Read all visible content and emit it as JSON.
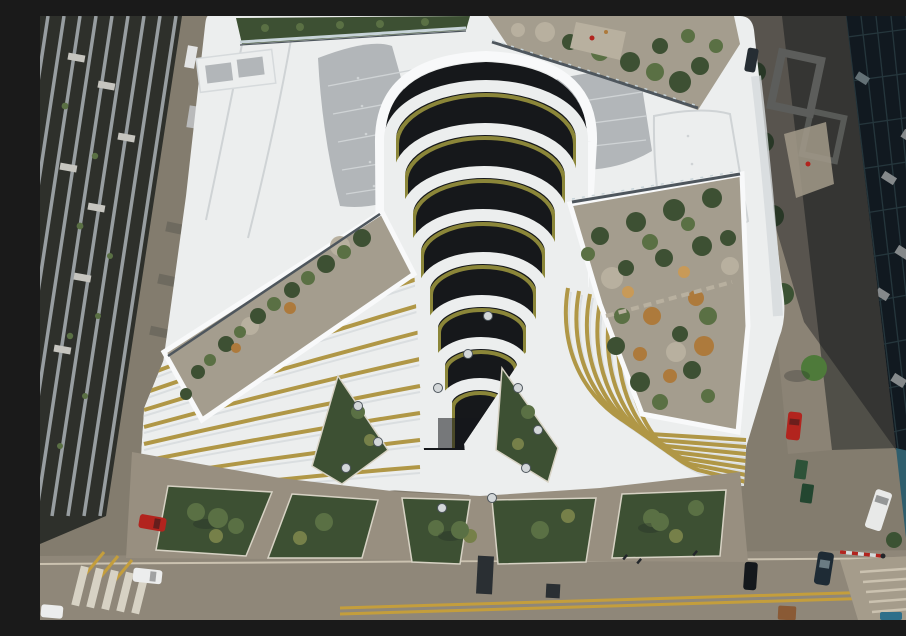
{
  "image": {
    "type": "aerial drone photograph",
    "subject": "Top-down aerial view of a white terraced office building with a cascading landscaped atrium canyon, gravel roof gardens, ground plaza with planting beds, flanked by city streets with parked cars and a glass tower"
  },
  "palette": {
    "street": "#837c6e",
    "road": "#8f8779",
    "road_line": "#c49e3c",
    "sidewalk": "#8b8375",
    "plaza": "#988f80",
    "white_roof": "#eceeee",
    "white_band": "#f8f9fa",
    "roof_shade": "#d6dadc",
    "roof_panel": "#b2b6b9",
    "panel_line": "#cfd3d5",
    "gravel": "#a49d8e",
    "gravel_light": "#b8b09f",
    "shrub_dark": "#3d5033",
    "shrub_mid": "#5a7044",
    "shrub_olive": "#768049",
    "shrub_dry": "#ad7a3c",
    "shrub_dry_light": "#c89a58",
    "grass_gold": "#b09746",
    "grass_olive": "#8b8639",
    "canyon": "#16181b",
    "left_bldg": "#2e302b",
    "left_bldg_strip": "#989ea1",
    "awning": "#c6c5bf",
    "alley_item": "#6e6a5f",
    "glass_tower": "#152028",
    "glass_line": "#3a565e",
    "glass_frame": "#d5dadb",
    "glass_tan": "#b3a478",
    "glass_teal": "#9fb3b8",
    "stone": "#504f48",
    "stone_frame": "#91928b",
    "pool": "#2f5e6d",
    "pool_light": "#7fa8b4",
    "tree": "#3b5233",
    "tree_bright": "#4e7a3a",
    "balustrade": "#4e565d",
    "balustrade_glass": "#c7d3d8",
    "skylight": "#d3d7d9",
    "curb": "#d7d2c4",
    "step": "#cbc2b0",
    "stairs": "#a59c8b",
    "grate": "#2a2f33",
    "people": "#22262a",
    "wedge": "#a29a8a",
    "shadow": "rgba(12,15,19,0.40)",
    "shadow_soft": "rgba(25,28,30,0.25)"
  },
  "vehicles": {
    "red_car_left": {
      "label": "red hatchback parked on left street",
      "color": "#b2241e"
    },
    "white_car_left": {
      "label": "white sedan parked on left street",
      "color": "#eceded"
    },
    "white_car_corner": {
      "label": "white car partially visible bottom-left",
      "color": "#eceded"
    },
    "silver_car_top": {
      "label": "silver car on upper left street",
      "color": "#b9babb"
    },
    "dark_car_top1": {
      "label": "dark car on upper left street",
      "color": "#2a3136"
    },
    "dark_car_top2": {
      "label": "dark car on upper left street",
      "color": "#3a4146"
    },
    "white_car_topleft": {
      "label": "white car at top of left street",
      "color": "#e4e5e5"
    },
    "red_car_right": {
      "label": "red car on right street",
      "color": "#b2241e"
    },
    "white_van_right": {
      "label": "white van on right street",
      "color": "#e8e9e8"
    },
    "dark_sedan_right": {
      "label": "dark sedan on right street",
      "color": "#1e2b35"
    },
    "black_car_right": {
      "label": "black car on right street",
      "color": "#14181c"
    },
    "dark_car_topright": {
      "label": "dark car at top of right street",
      "color": "#262d33"
    },
    "rust_truck": {
      "label": "rust-colored vehicle roof at bottom",
      "color": "#8a5a35"
    },
    "blue_car": {
      "label": "blue car partially visible bottom-right",
      "color": "#2e6f8a"
    },
    "dumpster_a": {
      "label": "green dumpster",
      "color": "#2d5238"
    },
    "dumpster_b": {
      "label": "green dumpster",
      "color": "#234630"
    }
  },
  "scene": {
    "terrace_arc_count": 8,
    "features": [
      "central cascading atrium canyon of nested U-shaped terraces",
      "olive-gold ornamental grass fringes on terrace edges",
      "gray leaf-shaped roof panels with seam dots",
      "gravel roof gardens with shrubs and dried orange grasses",
      "glass balustrades along roof garden edges",
      "diagonal white fins with golden grass on lower-left facade",
      "concentric curved terrace bands on lower-right facade",
      "ground plaza with branching paths, triangular planting beds and round skylights",
      "yellow double centerline on bottom road",
      "pedestrian crosswalk bottom-left",
      "parking barrier on right street",
      "teal glass tower facade on right edge"
    ]
  }
}
